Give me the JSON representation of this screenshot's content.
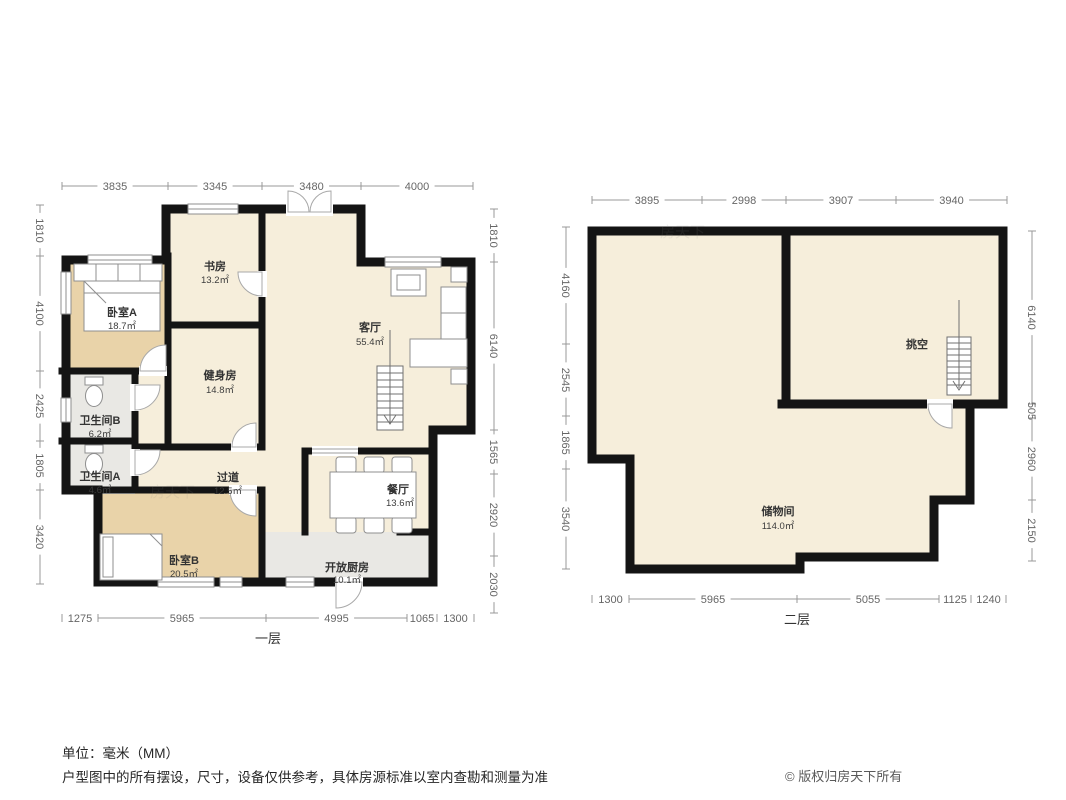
{
  "footer": {
    "unit_note": "单位：毫米（MM）",
    "disclaimer": "户型图中的所有摆设，尺寸，设备仅供参考，具体房源标准以室内查勘和测量为准",
    "copyright": "© 版权归房天下所有"
  },
  "watermark": "房天下",
  "colors": {
    "wall": "#141414",
    "room_fill": "#f6eedb",
    "bedroom_fill": "#e9d3a9",
    "service_fill": "#e9e8e4",
    "dim_line": "#999999",
    "dim_text": "#666666"
  },
  "floor1": {
    "label": "一层",
    "rooms": [
      {
        "name": "书房",
        "area": "13.2㎡"
      },
      {
        "name": "卧室A",
        "area": "18.7㎡"
      },
      {
        "name": "客厅",
        "area": "55.4㎡"
      },
      {
        "name": "健身房",
        "area": "14.8㎡"
      },
      {
        "name": "卫生间B",
        "area": "6.2㎡"
      },
      {
        "name": "卫生间A",
        "area": "4.6㎡"
      },
      {
        "name": "过道",
        "area": "12.5㎡"
      },
      {
        "name": "餐厅",
        "area": "13.6㎡"
      },
      {
        "name": "卧室B",
        "area": "20.5㎡"
      },
      {
        "name": "开放厨房",
        "area": "10.1㎡"
      }
    ],
    "dims": {
      "top": [
        "3835",
        "3345",
        "3480",
        "4000"
      ],
      "left": [
        "1810",
        "4100",
        "2425",
        "1805",
        "3420"
      ],
      "right": [
        "1810",
        "6140",
        "1565",
        "2920",
        "2030"
      ],
      "bottom": [
        "1275",
        "5965",
        "4995",
        "1065",
        "1300"
      ]
    }
  },
  "floor2": {
    "label": "二层",
    "rooms": [
      {
        "name": "挑空",
        "area": ""
      },
      {
        "name": "储物间",
        "area": "114.0㎡"
      }
    ],
    "dims": {
      "top": [
        "3895",
        "2998",
        "3907",
        "3940"
      ],
      "left": [
        "4160",
        "2545",
        "1865",
        "3540"
      ],
      "right": [
        "6140",
        "505",
        "2960",
        "2150"
      ],
      "bottom": [
        "1300",
        "5965",
        "5055",
        "1125",
        "1240"
      ]
    }
  }
}
